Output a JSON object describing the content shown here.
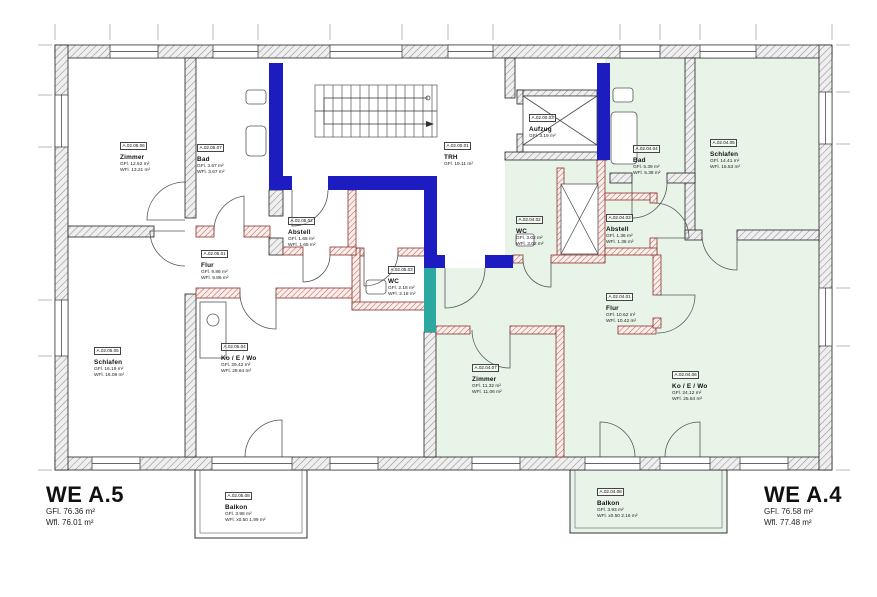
{
  "plan": {
    "apartment_left": {
      "name": "WE A.5",
      "gfl": "GFl. 76.36 m²",
      "wfl": "Wfl. 76.01 m²"
    },
    "apartment_right": {
      "name": "WE A.4",
      "gfl": "GFl. 76.58 m²",
      "wfl": "Wfl. 77.48 m²"
    }
  },
  "rooms": [
    {
      "code": "A.02.05.06",
      "name": "Zimmer",
      "gfl": "GFl. 12.52 m²",
      "wfl": "WFl. 13.21 m²"
    },
    {
      "code": "A.02.05.07",
      "name": "Bad",
      "gfl": "GFl. 3.67 m²",
      "wfl": "WFl. 3.67 m²"
    },
    {
      "code": "A.02.05.02",
      "name": "Abstell",
      "gfl": "GFl. 1.65 m²",
      "wfl": "WFl. 1.65 m²"
    },
    {
      "code": "A.02.05.01",
      "name": "Flur",
      "gfl": "GFl. 9.86 m²",
      "wfl": "WFl. 9.86 m²"
    },
    {
      "code": "A.02.05.03",
      "name": "WC",
      "gfl": "GFl. 2.18 m²",
      "wfl": "WFl. 2.18 m²"
    },
    {
      "code": "A.02.05.05",
      "name": "Schlafen",
      "gfl": "GFl. 16.19 m²",
      "wfl": "WFl. 16.08 m²"
    },
    {
      "code": "A.02.05.04",
      "name": "Ko / E / Wo",
      "gfl": "GFl. 29.42 m²",
      "wfl": "WFl. 29.64 m²"
    },
    {
      "code": "A.02.05.08",
      "name": "Balkon",
      "gfl": "GFl. 3.98 m²",
      "wfl": "WFl. x0.50  1.99 m²"
    },
    {
      "code": "A.02.00.01",
      "name": "TRH",
      "gfl": "GFl. 19.11 m²",
      "wfl": null
    },
    {
      "code": "A.02.00.03",
      "name": "Aufzug",
      "gfl": "GFl. 3.19 m²",
      "wfl": null
    },
    {
      "code": "A.02.04.02",
      "name": "WC",
      "gfl": "GFl. 3.02 m²",
      "wfl": "WFl. 3.02 m²"
    },
    {
      "code": "A.02.04.04",
      "name": "Bad",
      "gfl": "GFl. 5.39 m²",
      "wfl": "WFl. 5.38 m²"
    },
    {
      "code": "A.02.04.03",
      "name": "Abstell",
      "gfl": "GFl. 1.36 m²",
      "wfl": "WFl. 1.36 m²"
    },
    {
      "code": "A.02.04.05",
      "name": "Schlafen",
      "gfl": "GFl. 14.41 m²",
      "wfl": "WFl. 15.53 m²"
    },
    {
      "code": "A.02.04.01",
      "name": "Flur",
      "gfl": "GFl. 10.62 m²",
      "wfl": "WFl. 10.42 m²"
    },
    {
      "code": "A.02.04.07",
      "name": "Zimmer",
      "gfl": "GFl. 11.32 m²",
      "wfl": "WFl. 11.06 m²"
    },
    {
      "code": "A.02.04.06",
      "name": "Ko / E / Wo",
      "gfl": "GFl. 24.12 m²",
      "wfl": "WFl. 25.64 m²"
    },
    {
      "code": "A.02.04.08",
      "name": "Balkon",
      "gfl": "GFl. 3.93 m²",
      "wfl": "WFl. x0.50  2.16 m²"
    }
  ],
  "colors": {
    "core_wall_blue": "#1c1cc0",
    "core_wall_teal": "#2ba8a0",
    "apartment_a4_tint": "#e9f4e9",
    "structural_hatch": "#909090",
    "partition_hatch": "#c2564e"
  }
}
